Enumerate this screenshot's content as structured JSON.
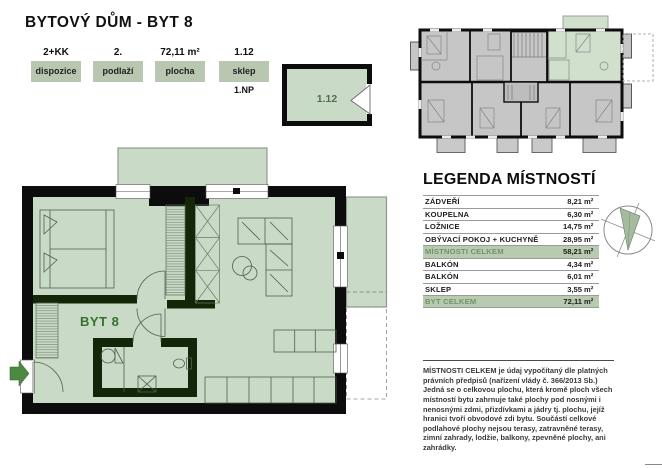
{
  "page": {
    "title": "BYTOVÝ DŮM - BYT 8"
  },
  "summary": {
    "boxes": [
      {
        "value": "2+KK",
        "label": "dispozice",
        "note": ""
      },
      {
        "value": "2.",
        "label": "podlaží",
        "note": ""
      },
      {
        "value": "72,11 m²",
        "label": "plocha",
        "note": ""
      },
      {
        "value": "1.12",
        "label": "sklep",
        "note": "1.NP"
      }
    ]
  },
  "storage_plan": {
    "label": "1.12"
  },
  "floor_plan": {
    "label": "BYT 8"
  },
  "legend": {
    "title": "LEGENDA MÍSTNOSTÍ",
    "rows": [
      {
        "name": "ZÁDVEŘÍ",
        "value": "8,21",
        "unit": "m²"
      },
      {
        "name": "KOUPELNA",
        "value": "6,30",
        "unit": "m²"
      },
      {
        "name": "LOŽNICE",
        "value": "14,75",
        "unit": "m²"
      },
      {
        "name": "OBÝVACÍ POKOJ + KUCHYNĚ",
        "value": "28,95",
        "unit": "m²"
      },
      {
        "name": "MÍSTNOSTI CELKEM",
        "value": "58,21",
        "unit": "m²",
        "highlight": true
      },
      {
        "name": "BALKÓN",
        "value": "4,34",
        "unit": "m²"
      },
      {
        "name": "BALKÓN",
        "value": "6,01",
        "unit": "m²"
      },
      {
        "name": "SKLEP",
        "value": "3,55",
        "unit": "m²"
      },
      {
        "name": "BYT CELKEM",
        "value": "72,11",
        "unit": "m²",
        "highlight": true
      }
    ]
  },
  "note": "MÍSTNOSTI CELKEM je údaj vypočítaný dle platných právních předpisů (nařízení vlády č. 366/2013 Sb.) Jedná se o celkovou plochu, která kromě ploch všech místností bytu zahrnuje také plochy pod nosnými i nenosnými zdmi, přizdívkami a jádry tj. plochu, jejíž hranici tvoří obvodové zdi bytu. Součástí celkové podlahové plochy nejsou terasy, zatravněné terasy, zimní zahrady, lodžie, balkony, zpevněné plochy, ani zahrádky.",
  "colors": {
    "plan_fill": "#c9dac7",
    "overview_fill": "#c6c6c6",
    "highlight_row": "#b8cab0",
    "accent_green": "#35702e",
    "wall_black": "#0c0c0c",
    "interior_wall": "#152508"
  }
}
